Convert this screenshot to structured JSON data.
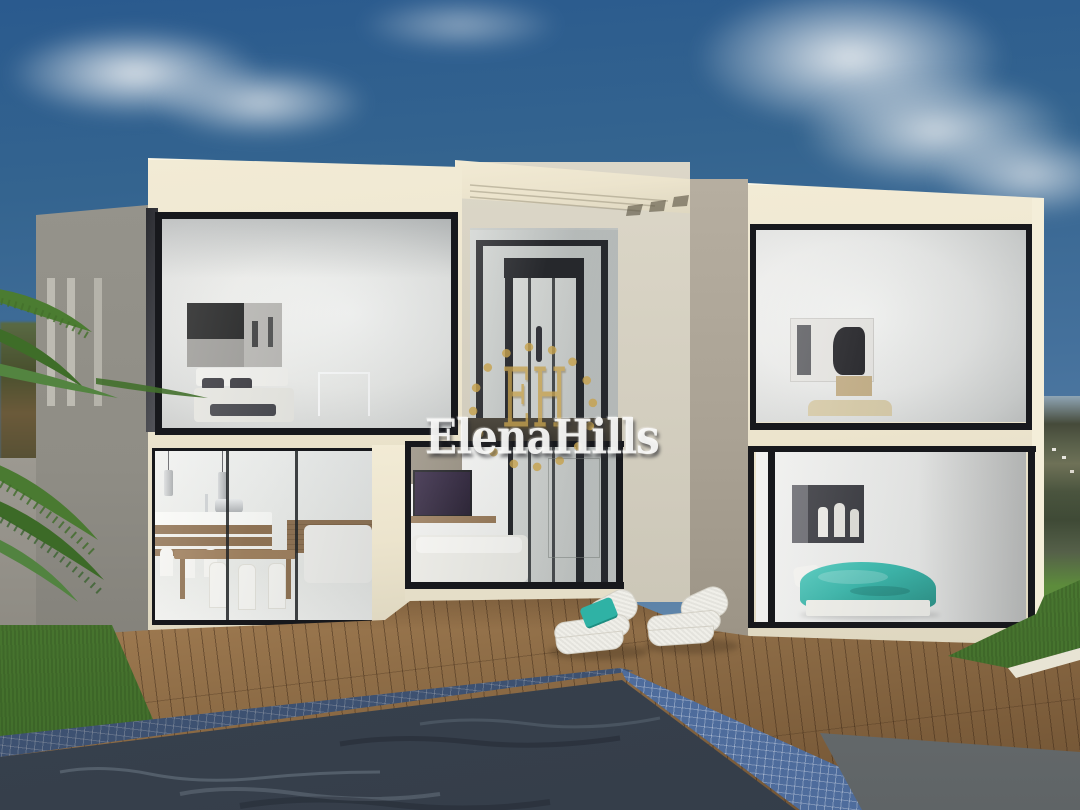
{
  "meta": {
    "kind": "3d-architectural-render",
    "description": "Modern two-storey white villa with floor-to-ceiling corner glazing, interior glass elevator, wooden pool deck with two wicker loungers, mosaic-tiled swimming pool, palm fronds and distant hillside under a blue sky with clouds"
  },
  "watermark": {
    "monogram": "EH",
    "brand": "ElenaHills"
  },
  "colors": {
    "sky_top": "#2a5a8e",
    "cloud": "#e9edf0",
    "facade_lit": "#ece4cd",
    "facade_shadow": "#aaa294",
    "wall_side_gray": "#8f8d85",
    "frame_black": "#17181c",
    "glass_light": "#d9dbd8",
    "deck_wood": "#8d6c46",
    "pool_tile": "#4e6c9c",
    "pool_water": "#3a434f",
    "grass": "#4d7c33",
    "palm_green": "#4a7a30",
    "bed_teal": "#2fb2a5",
    "gold": "#c6a24f"
  },
  "scene": {
    "rooms": [
      {
        "id": "bedroom-upper-left",
        "note": "bed with dark pillows, panoramic b/w artwork, glass console"
      },
      {
        "id": "kitchen-dining",
        "note": "island with pendant lamps, wood dining table, white chairs, white sofa"
      },
      {
        "id": "tv-lounge",
        "note": "wall tv, wood shelf, white sofa"
      },
      {
        "id": "elevator",
        "note": "glass elevator shaft with black cabin frame"
      },
      {
        "id": "bedroom-upper-right",
        "note": "figure artwork, tan bedding"
      },
      {
        "id": "bedroom-lower-right",
        "note": "teal duvet bed, dark gallery artwork"
      }
    ],
    "exterior": [
      "palm-fronds",
      "wood-deck",
      "wicker-lounger-with-teal-cushion",
      "wicker-lounger",
      "mosaic-pool",
      "lawn",
      "hillside-with-houses",
      "perimeter-wall"
    ]
  }
}
